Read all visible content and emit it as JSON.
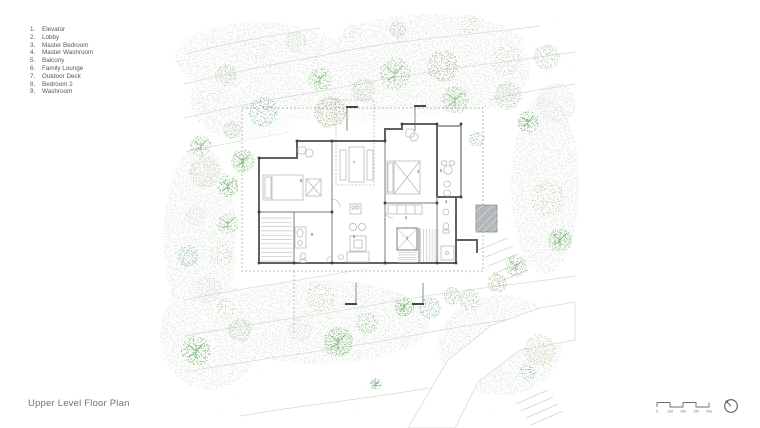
{
  "title": "Upper Level Floor Plan",
  "legend": {
    "items": [
      {
        "num": "1.",
        "label": "Elevator"
      },
      {
        "num": "2.",
        "label": "Lobby"
      },
      {
        "num": "3.",
        "label": "Master Bedroom"
      },
      {
        "num": "4.",
        "label": "Master Washroom"
      },
      {
        "num": "5.",
        "label": "Balcony"
      },
      {
        "num": "6.",
        "label": "Family Lounge"
      },
      {
        "num": "7.",
        "label": "Outdoor Deck"
      },
      {
        "num": "8.",
        "label": "Bedroom 2"
      },
      {
        "num": "9.",
        "label": "Washroom"
      }
    ]
  },
  "rooms": [
    {
      "num": "1",
      "name": "Elevator",
      "x": 407,
      "y": 239
    },
    {
      "num": "2",
      "name": "Lobby",
      "x": 406,
      "y": 219
    },
    {
      "num": "3",
      "name": "Master Bedroom",
      "x": 418,
      "y": 173
    },
    {
      "num": "4",
      "name": "Master Washroom",
      "x": 446,
      "y": 203
    },
    {
      "num": "5",
      "name": "Balcony",
      "x": 441,
      "y": 172
    },
    {
      "num": "6",
      "name": "Family Lounge",
      "x": 354,
      "y": 238
    },
    {
      "num": "7",
      "name": "Outdoor Deck",
      "x": 354,
      "y": 164
    },
    {
      "num": "8",
      "name": "Bedroom 2",
      "x": 301,
      "y": 182
    },
    {
      "num": "9",
      "name": "Washroom",
      "x": 312,
      "y": 236
    }
  ],
  "scale_bar": {
    "labels": [
      "0",
      "1M",
      "2M",
      "3M",
      "5M"
    ]
  },
  "colors": {
    "wall": "#5d6266",
    "wall_light": "#8d9396",
    "furniture": "#b6bcb7",
    "boundary_dash": "#9aa19b",
    "contour": "#d4d9d3",
    "ground": "#b7c3bd",
    "label_text": "#5f6468",
    "title_text": "#6e7377",
    "hatch_fill": "#b2b8ba",
    "tree_palette": {
      "bright": "#74b06e",
      "mid": "#8fbc86",
      "sage": "#a9c29f",
      "pale": "#c6d3ba",
      "olive": "#9aa878",
      "paleolive": "#c4cba3",
      "teal": "#7fb3ab",
      "palegray": "#d6dbd3"
    }
  },
  "trees": [
    [
      201,
      146,
      11,
      "mid",
      1
    ],
    [
      232,
      130,
      9,
      "sage",
      0
    ],
    [
      263,
      112,
      15,
      "teal",
      0
    ],
    [
      243,
      161,
      12,
      "bright",
      1
    ],
    [
      208,
      100,
      12,
      "palegray",
      0
    ],
    [
      226,
      75,
      11,
      "sage",
      0
    ],
    [
      256,
      52,
      12,
      "palegray",
      0
    ],
    [
      296,
      42,
      11,
      "pale",
      0
    ],
    [
      320,
      79,
      12,
      "mid",
      1
    ],
    [
      330,
      112,
      16,
      "olive",
      0
    ],
    [
      352,
      34,
      10,
      "palegray",
      0
    ],
    [
      363,
      90,
      12,
      "sage",
      0
    ],
    [
      395,
      74,
      16,
      "mid",
      1
    ],
    [
      398,
      30,
      9,
      "sage",
      0
    ],
    [
      443,
      66,
      16,
      "olive",
      0
    ],
    [
      455,
      100,
      14,
      "mid",
      1
    ],
    [
      470,
      24,
      10,
      "pale",
      0
    ],
    [
      477,
      139,
      8,
      "teal",
      0
    ],
    [
      505,
      60,
      16,
      "pale",
      0
    ],
    [
      508,
      96,
      14,
      "sage",
      0
    ],
    [
      528,
      122,
      11,
      "bright",
      1
    ],
    [
      556,
      103,
      20,
      "palegray",
      0
    ],
    [
      547,
      57,
      13,
      "sage",
      0
    ],
    [
      205,
      172,
      16,
      "paleolive",
      0
    ],
    [
      228,
      186,
      11,
      "bright",
      1
    ],
    [
      196,
      216,
      10,
      "palegray",
      0
    ],
    [
      228,
      224,
      11,
      "mid",
      1
    ],
    [
      188,
      256,
      11,
      "teal",
      0
    ],
    [
      222,
      254,
      12,
      "paleolive",
      0
    ],
    [
      208,
      290,
      14,
      "palegray",
      0
    ],
    [
      196,
      351,
      15,
      "bright",
      1
    ],
    [
      240,
      330,
      12,
      "sage",
      0
    ],
    [
      226,
      308,
      10,
      "paleolive",
      0
    ],
    [
      300,
      330,
      12,
      "palegray",
      0
    ],
    [
      321,
      298,
      15,
      "paleolive",
      0
    ],
    [
      338,
      342,
      15,
      "bright",
      1
    ],
    [
      367,
      323,
      11,
      "mid",
      0
    ],
    [
      404,
      307,
      10,
      "bright",
      1
    ],
    [
      430,
      308,
      11,
      "teal",
      0
    ],
    [
      452,
      296,
      9,
      "mid",
      0
    ],
    [
      470,
      300,
      11,
      "sage",
      0
    ],
    [
      497,
      283,
      10,
      "olive",
      0
    ],
    [
      516,
      266,
      11,
      "mid",
      1
    ],
    [
      560,
      240,
      12,
      "bright",
      1
    ],
    [
      548,
      198,
      18,
      "paleolive",
      0
    ],
    [
      540,
      350,
      16,
      "paleolive",
      0
    ],
    [
      527,
      372,
      9,
      "teal",
      0
    ],
    [
      376,
      384,
      6,
      "bright",
      1
    ]
  ]
}
